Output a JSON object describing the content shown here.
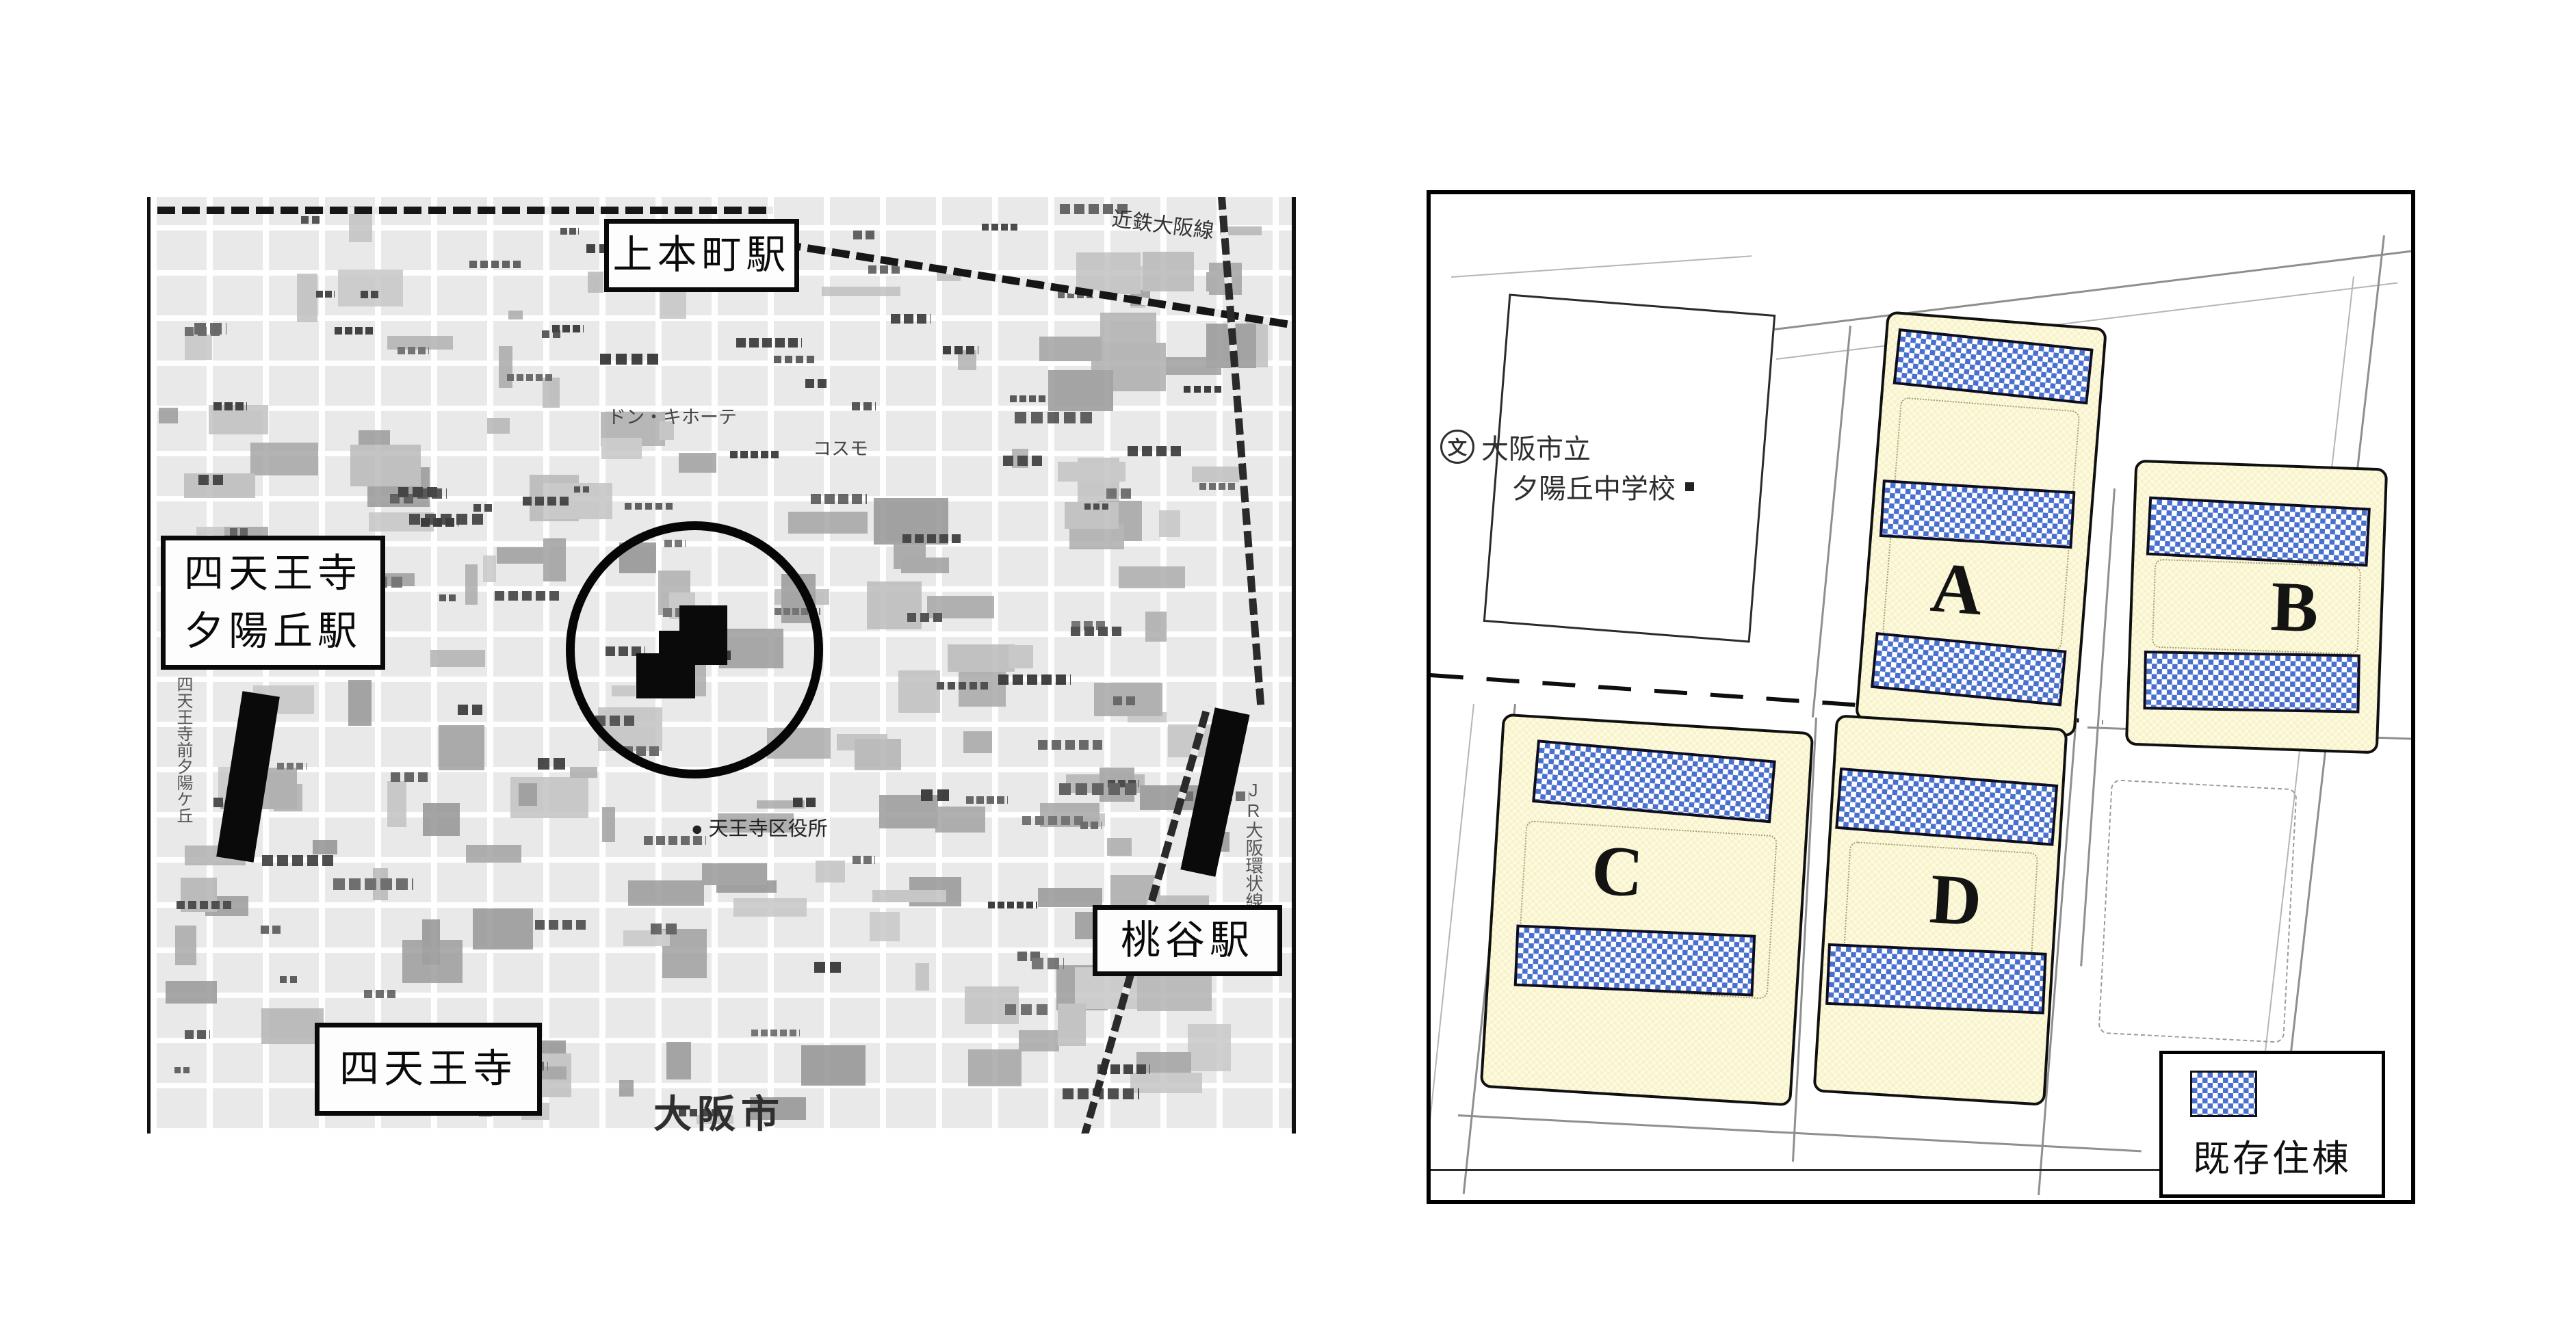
{
  "left_map": {
    "boxed_labels": {
      "uehommachi": "上本町駅",
      "shitennoji_line1": "四天王寺",
      "yuhigaoka_line2": "夕陽丘駅",
      "momodani": "桃谷駅",
      "shitennoji_south": "四天王寺"
    },
    "city_name": "大阪市",
    "small_labels": {
      "kintetsu_line": "近鉄大阪線",
      "donki": "ドン・キホーテ",
      "cosmo": "コスモ",
      "ward_office_marker": "●",
      "ward_office": "天王寺区役所",
      "jr_loop_line": "JR大阪環状線",
      "station_name_vertical": "四天王寺前夕陽ケ丘"
    }
  },
  "right_map": {
    "school": {
      "symbol": "文",
      "line1": "大阪市立",
      "line2": "夕陽丘中学校"
    },
    "blocks": [
      {
        "letter": "A",
        "buildings": 3
      },
      {
        "letter": "B",
        "buildings": 2
      },
      {
        "letter": "C",
        "buildings": 2
      },
      {
        "letter": "D",
        "buildings": 2
      }
    ],
    "legend": {
      "label": "既存住棟"
    },
    "colors": {
      "block_fill": "#f8f3c6",
      "building_fill": "#4a70cf",
      "outline": "#101010"
    }
  }
}
